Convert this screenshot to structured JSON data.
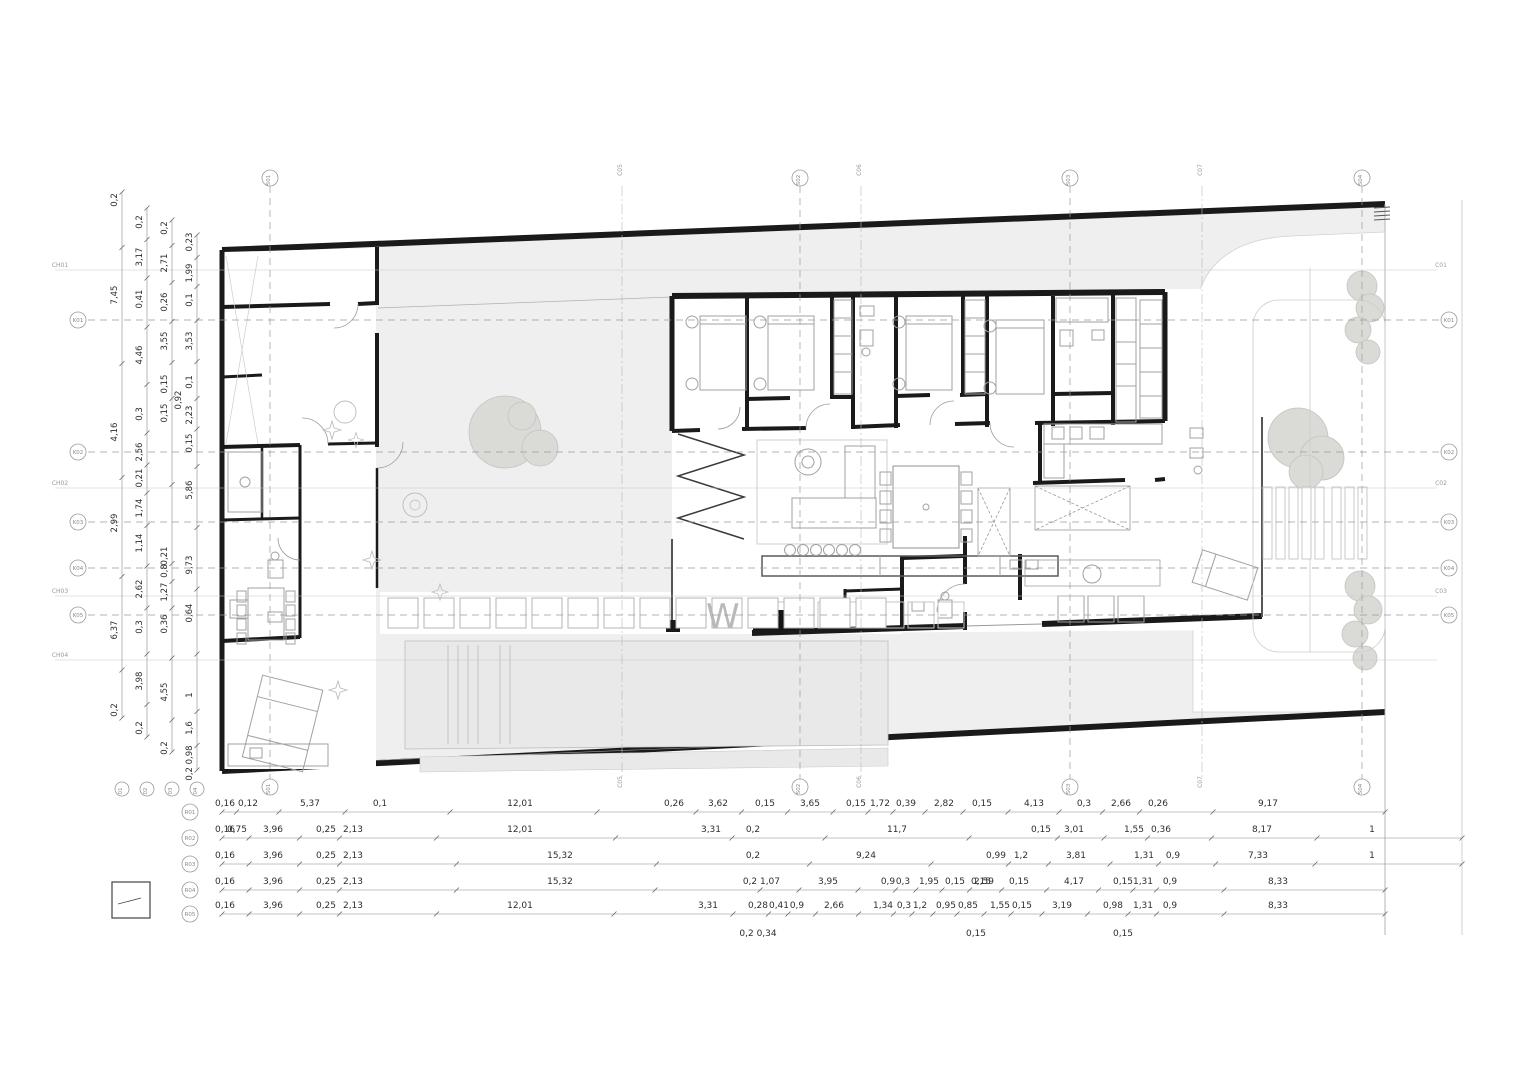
{
  "drawing": {
    "watermark": "W",
    "colors": {
      "wall": "#1a1a1a",
      "site_fill": "#efefef",
      "furniture": "#a0a0a0",
      "grid": "#9a9a9a",
      "dim_text": "#2e2e2e",
      "tree_fill": "#dadbd7"
    }
  },
  "grid": {
    "vertical_axes": [
      {
        "label": "S01",
        "x": 270
      },
      {
        "label": "S02",
        "x": 800
      },
      {
        "label": "S03",
        "x": 1070
      },
      {
        "label": "S04",
        "x": 1362
      }
    ],
    "vertical_sections": [
      {
        "label": "C05",
        "x": 622
      },
      {
        "label": "C06",
        "x": 861
      },
      {
        "label": "C07",
        "x": 1202
      }
    ],
    "horizontal_axes": [
      {
        "label": "K01",
        "y": 320
      },
      {
        "label": "K02",
        "y": 452
      },
      {
        "label": "K03",
        "y": 522
      },
      {
        "label": "K04",
        "y": 568
      },
      {
        "label": "K05",
        "y": 615
      }
    ],
    "left_section_labels": [
      {
        "label": "CH01",
        "y": 270
      },
      {
        "label": "CH02",
        "y": 488
      },
      {
        "label": "CH03",
        "y": 596
      },
      {
        "label": "CH04",
        "y": 660
      }
    ],
    "right_section_labels": [
      {
        "label": "C01",
        "y": 270
      },
      {
        "label": "C02",
        "y": 488
      },
      {
        "label": "C03",
        "y": 596
      }
    ]
  },
  "dimensions": {
    "left_chains": [
      {
        "label": "01",
        "x": 122,
        "y1": 192,
        "y2": 718,
        "values": [
          [
            200,
            "0,2"
          ],
          [
            295,
            "7,45"
          ],
          [
            432,
            "4,16"
          ],
          [
            523,
            "2,99"
          ],
          [
            630,
            "6,37"
          ],
          [
            710,
            "0,2"
          ]
        ]
      },
      {
        "label": "02",
        "x": 147,
        "y1": 208,
        "y2": 737,
        "values": [
          [
            222,
            "0,2"
          ],
          [
            257,
            "3,17"
          ],
          [
            299,
            "0,41"
          ],
          [
            355,
            "4,46"
          ],
          [
            414,
            "0,3"
          ],
          [
            452,
            "2,56"
          ],
          [
            478,
            "0,21"
          ],
          [
            508,
            "1,74"
          ],
          [
            543,
            "1,14"
          ],
          [
            589,
            "2,62"
          ],
          [
            627,
            "0,3"
          ],
          [
            681,
            "3,98"
          ],
          [
            728,
            "0,2"
          ]
        ]
      },
      {
        "label": "03",
        "x": 172,
        "y1": 220,
        "y2": 752,
        "values": [
          [
            228,
            "0,2"
          ],
          [
            263,
            "2,71"
          ],
          [
            302,
            "0,26"
          ],
          [
            341,
            "3,55"
          ],
          [
            384,
            "0,15"
          ],
          [
            413,
            "0,15"
          ],
          [
            556,
            "0,21"
          ],
          [
            571,
            "0,8"
          ],
          [
            592,
            "1,27"
          ],
          [
            624,
            "0,36"
          ],
          [
            692,
            "4,55"
          ],
          [
            748,
            "0,2"
          ]
        ]
      },
      {
        "label": "04",
        "x": 197,
        "y1": 235,
        "y2": 770,
        "values": [
          [
            242,
            "0,23"
          ],
          [
            273,
            "1,99"
          ],
          [
            300,
            "0,1"
          ],
          [
            341,
            "3,53"
          ],
          [
            382,
            "0,1"
          ],
          [
            415,
            "2,23"
          ],
          [
            443,
            "0,15"
          ],
          [
            490,
            "5,86"
          ],
          [
            565,
            "9,73"
          ],
          [
            613,
            "0,64"
          ],
          [
            695,
            "1"
          ],
          [
            728,
            "1,6"
          ],
          [
            763,
            "0,2 0,98"
          ]
        ]
      }
    ],
    "left_extras": [
      [
        181,
        400,
        "0,92"
      ]
    ],
    "bottom_rows": [
      {
        "label": "R01",
        "y": 812,
        "x1": 222,
        "x2": 1385,
        "values": [
          [
            225,
            "0,16"
          ],
          [
            248,
            "0,12"
          ],
          [
            310,
            "5,37"
          ],
          [
            380,
            "0,1"
          ],
          [
            520,
            "12,01"
          ],
          [
            674,
            "0,26"
          ],
          [
            718,
            "3,62"
          ],
          [
            765,
            "0,15"
          ],
          [
            810,
            "3,65"
          ],
          [
            856,
            "0,15"
          ],
          [
            880,
            "1,72"
          ],
          [
            906,
            "0,39"
          ],
          [
            944,
            "2,82"
          ],
          [
            982,
            "0,15"
          ],
          [
            1034,
            "4,13"
          ],
          [
            1084,
            "0,3"
          ],
          [
            1121,
            "2,66"
          ],
          [
            1158,
            "0,26"
          ],
          [
            1268,
            "9,17"
          ]
        ],
        "subs": [
          [
            237,
            824,
            "0,75"
          ]
        ]
      },
      {
        "label": "R02",
        "y": 838,
        "x1": 222,
        "x2": 1462,
        "values": [
          [
            225,
            "0,16"
          ],
          [
            273,
            "3,96"
          ],
          [
            326,
            "0,25"
          ],
          [
            353,
            "2,13"
          ],
          [
            520,
            "12,01"
          ],
          [
            711,
            "3,31"
          ],
          [
            753,
            "0,2"
          ],
          [
            897,
            "11,7"
          ],
          [
            1041,
            "0,15"
          ],
          [
            1074,
            "3,01"
          ],
          [
            1134,
            "1,55"
          ],
          [
            1161,
            "0,36"
          ],
          [
            1262,
            "8,17"
          ],
          [
            1372,
            "1"
          ]
        ],
        "subs": []
      },
      {
        "label": "R03",
        "y": 864,
        "x1": 222,
        "x2": 1462,
        "values": [
          [
            225,
            "0,16"
          ],
          [
            273,
            "3,96"
          ],
          [
            326,
            "0,25"
          ],
          [
            353,
            "2,13"
          ],
          [
            560,
            "15,32"
          ],
          [
            753,
            "0,2"
          ],
          [
            866,
            "9,24"
          ],
          [
            996,
            "0,99"
          ],
          [
            1021,
            "1,2"
          ],
          [
            1076,
            "3,81"
          ],
          [
            1144,
            "1,31"
          ],
          [
            1173,
            "0,9"
          ],
          [
            1258,
            "7,33"
          ],
          [
            1372,
            "1"
          ]
        ],
        "subs": [
          [
            981,
            876,
            "0,15"
          ]
        ]
      },
      {
        "label": "R04",
        "y": 890,
        "x1": 222,
        "x2": 1385,
        "values": [
          [
            225,
            "0,16"
          ],
          [
            273,
            "3,96"
          ],
          [
            326,
            "0,25"
          ],
          [
            353,
            "2,13"
          ],
          [
            560,
            "15,32"
          ],
          [
            750,
            "0,2"
          ],
          [
            770,
            "1,07"
          ],
          [
            828,
            "3,95"
          ],
          [
            888,
            "0,9"
          ],
          [
            903,
            "0,3"
          ],
          [
            929,
            "1,95"
          ],
          [
            955,
            "0,15"
          ],
          [
            984,
            "2,59"
          ],
          [
            1019,
            "0,15"
          ],
          [
            1074,
            "4,17"
          ],
          [
            1123,
            "0,15"
          ],
          [
            1143,
            "1,31"
          ],
          [
            1170,
            "0,9"
          ],
          [
            1278,
            "8,33"
          ]
        ],
        "subs": []
      },
      {
        "label": "R05",
        "y": 914,
        "x1": 222,
        "x2": 1385,
        "values": [
          [
            225,
            "0,16"
          ],
          [
            273,
            "3,96"
          ],
          [
            326,
            "0,25"
          ],
          [
            353,
            "2,13"
          ],
          [
            520,
            "12,01"
          ],
          [
            708,
            "3,31"
          ],
          [
            758,
            "0,28"
          ],
          [
            779,
            "0,41"
          ],
          [
            797,
            "0,9"
          ],
          [
            834,
            "2,66"
          ],
          [
            883,
            "1,34"
          ],
          [
            904,
            "0,3"
          ],
          [
            920,
            "1,2"
          ],
          [
            946,
            "0,95"
          ],
          [
            968,
            "0,85"
          ],
          [
            1000,
            "1,55"
          ],
          [
            1022,
            "0,15"
          ],
          [
            1062,
            "3,19"
          ],
          [
            1113,
            "0,98"
          ],
          [
            1143,
            "1,31"
          ],
          [
            1170,
            "0,9"
          ],
          [
            1278,
            "8,33"
          ]
        ],
        "subs": [
          [
            758,
            928,
            "0,2 0,34"
          ],
          [
            976,
            928,
            "0,15"
          ],
          [
            1123,
            928,
            "0,15"
          ]
        ]
      }
    ]
  }
}
